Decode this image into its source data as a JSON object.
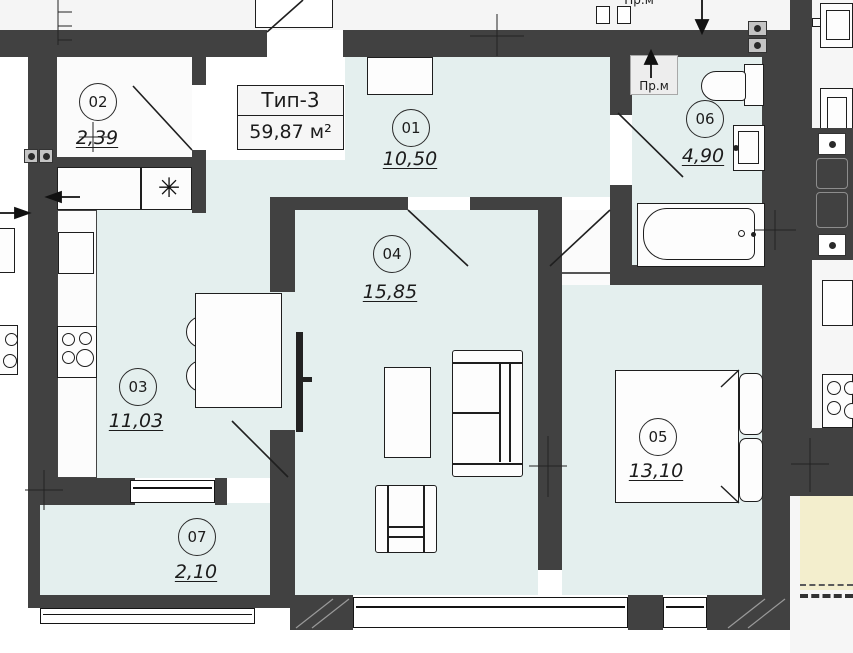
{
  "plan": {
    "title_block": {
      "type_label": "Тип-3",
      "area_label": "59,87 м²"
    },
    "rooms": [
      {
        "number": "01",
        "area": "10,50"
      },
      {
        "number": "02",
        "area": "2,39"
      },
      {
        "number": "03",
        "area": "11,03"
      },
      {
        "number": "04",
        "area": "15,85"
      },
      {
        "number": "05",
        "area": "13,10"
      },
      {
        "number": "06",
        "area": "4,90"
      },
      {
        "number": "07",
        "area": "2,10"
      }
    ],
    "annotations": {
      "washing_machine_label": "Пр.м",
      "corridor_label": "Пр.м",
      "vent_symbol": "✳"
    },
    "colors": {
      "wall": "#414141",
      "room_fill": "#e4efee",
      "white_fill": "#fbfbfb",
      "balcony_fill": "#f3eecd",
      "line": "#1f1f1f"
    }
  }
}
